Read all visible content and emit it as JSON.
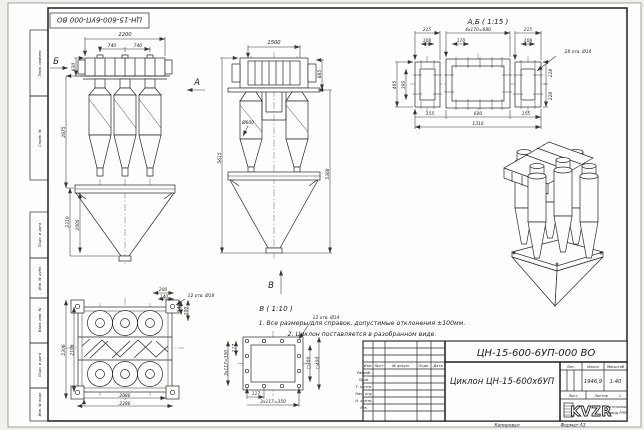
{
  "sheet": {
    "top_stamp": "ЦН-15-600-6УП-000 ВО",
    "margin_labels": [
      "Перв. примен.",
      "Справ. №",
      "Подп. и дата",
      "Инв. № дубл.",
      "Взам. инв. №",
      "Подп. и дата",
      "Инв. № подл."
    ]
  },
  "front_view": {
    "dim_width": "2200",
    "dim_pitch1": "740",
    "dim_pitch2": "740",
    "dim_inlet": "630",
    "dim_body": "2675",
    "dim_hopper": "2310",
    "dim_cone": "2005",
    "arrow_a": "А",
    "arrow_b": "Б"
  },
  "side_view": {
    "dim_width": "1500",
    "dim_flange": "685",
    "dim_height_left": "5615",
    "dim_height_right": "5368",
    "dim_diameter": "Ø600",
    "arrow_v": "В"
  },
  "section_ab": {
    "title": "А,Б ( 1:15 )",
    "dim_215_left": "215",
    "dim_pitch": "4х170=680",
    "dim_215_right": "215",
    "dim_108_left": "108",
    "dim_170": "170",
    "dim_108_right": "108",
    "holes_note": "28 отв. Ø14",
    "dim_495": "495",
    "dim_395": "395",
    "dim_228_top": "228",
    "dim_228_bottom": "228",
    "dim_155_left": "155",
    "dim_620": "620",
    "dim_155_right": "155",
    "dim_1310": "1310"
  },
  "plan_view": {
    "dim_200_top": "200",
    "dim_140_top": "140",
    "holes_note": "12 отв. Ø18",
    "dim_140_right": "140",
    "dim_200_right": "200",
    "dim_2306": "2306",
    "dim_2106": "2106",
    "dim_2086": "2086",
    "dim_2286": "2286"
  },
  "detail_v": {
    "title": "В ( 1:10 )",
    "holes_note": "12 отв. Ø14",
    "dim_300": "□300",
    "dim_400": "□400",
    "dim_117_bottom": "117",
    "dim_pitch_bottom": "3х117=350",
    "dim_117_left": "117",
    "dim_pitch_left": "3х117=350"
  },
  "notes": {
    "line1": "1. Все размеры для справок, допустимые отклонения ±100мм.",
    "line2": "2. Циклон поставляется в разобранном виде."
  },
  "title_block": {
    "designation": "ЦН-15-600-6УП-000 ВО",
    "name": "Циклон ЦН-15-600х6УП",
    "lit_label": "Лит.",
    "mass_label": "Масса",
    "scale_label": "Масштаб",
    "mass": "1946,9",
    "scale": "1:40",
    "sheet_label": "Лист",
    "sheets_label": "Листов",
    "sheets_value": "1",
    "col_izm": "Изм.",
    "col_list": "Лист",
    "col_doc": "№ докум.",
    "col_podp": "Подп.",
    "col_data": "Дата",
    "rows": [
      "Разраб.",
      "Пров.",
      "Т. контр.",
      "Нач. отд.",
      "Н. контр.",
      "Утв."
    ],
    "logo": "KVZR",
    "company_line1": "Котельный",
    "company_line2": "завод РЭП",
    "copied": "Копировал",
    "format": "Формат А3"
  }
}
